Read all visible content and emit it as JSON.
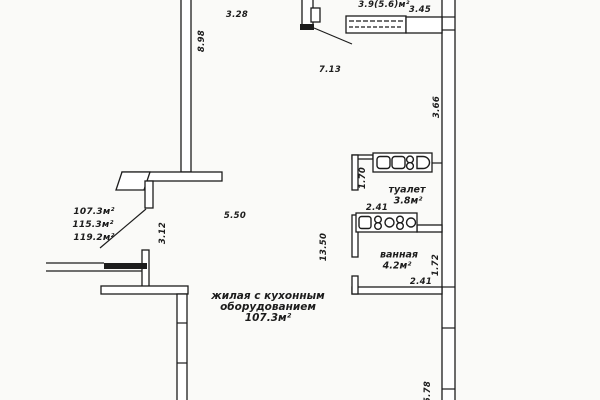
{
  "drawing": {
    "type": "apartment-floor-plan",
    "colors": {
      "line": "#1c1c1c",
      "background": "#fafaf8"
    }
  },
  "rooms": {
    "living": {
      "label_line1": "жилая с кухонным",
      "label_line2": "оборудованием",
      "area": "107.3м²"
    },
    "toilet": {
      "label": "туалет",
      "area": "3.8м²"
    },
    "bathroom": {
      "label": "ванная",
      "area": "4.2м²"
    },
    "balcony": {
      "area": "3.9(5.6)м²"
    }
  },
  "area_totals": {
    "line1": "107.3м²",
    "line2": "115.3м²",
    "line3": "119.2м²"
  },
  "dims": {
    "top_width": "3.28",
    "left_height": "8.98",
    "hall_width": "7.13",
    "balcony_width": "3.45",
    "right_upper": "3.66",
    "mid_width": "5.50",
    "mid_height": "13.50",
    "niche_height": "3.12",
    "toilet_depth": "1.70",
    "toilet_width": "2.41",
    "bath_depth": "1.72",
    "bath_width": "2.41",
    "right_lower": "5.78"
  },
  "icons": {
    "toilet_fixtures": "sanitary-fixtures-row",
    "bathroom_fixtures": "sanitary-fixtures-row",
    "entry_door": "door-swing",
    "balcony_partition": "hatched-partition"
  }
}
